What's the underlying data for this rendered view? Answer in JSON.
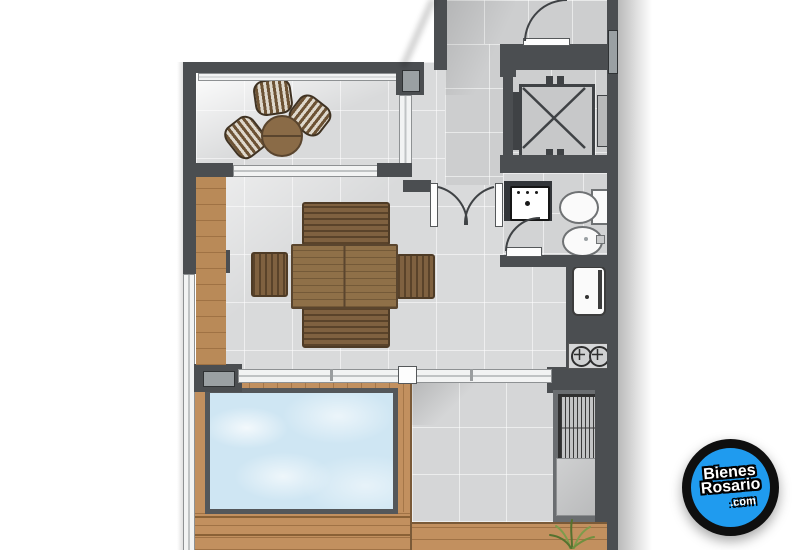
{
  "canvas": {
    "width": 800,
    "height": 550
  },
  "watermark_logo": {
    "line1": "Bienes",
    "line2": "Rosario",
    "line3": ".com",
    "circle_color": "#1f9bef",
    "ring_color": "#0f0f0f",
    "text_color": "#ffffff"
  },
  "palette": {
    "wall": "#4b4e51",
    "tile_living": "#d9dadb",
    "tile_hall": "#cdcecf",
    "tile_bath": "#d2d3d4",
    "tile_patio": "#d5d6d7",
    "wood_deck": "#c2905f",
    "wood_furn": "#7f6140",
    "pool": "#cfe6f3",
    "glass": "#f2f3f3",
    "fixture": "#fafafa",
    "grass": "#6f8f3f",
    "logo_blue": "#1f9bef"
  },
  "elements": {
    "rooms": [
      "terrace",
      "living-dining",
      "entry-hall",
      "corridor",
      "elevator",
      "bathroom",
      "kitchen",
      "patio",
      "pool-deck"
    ],
    "fixtures": [
      "terrace-woven-chairs",
      "terrace-round-table",
      "dining-table",
      "dining-benches",
      "dining-chairs",
      "sliding-glass-door",
      "window",
      "pool",
      "sink-vanity",
      "toilet",
      "bidet",
      "fridge",
      "stove-burners",
      "grill",
      "counter",
      "grass-plant",
      "entry-door",
      "double-door",
      "bathroom-door",
      "elevator-car",
      "glass-railing"
    ]
  }
}
